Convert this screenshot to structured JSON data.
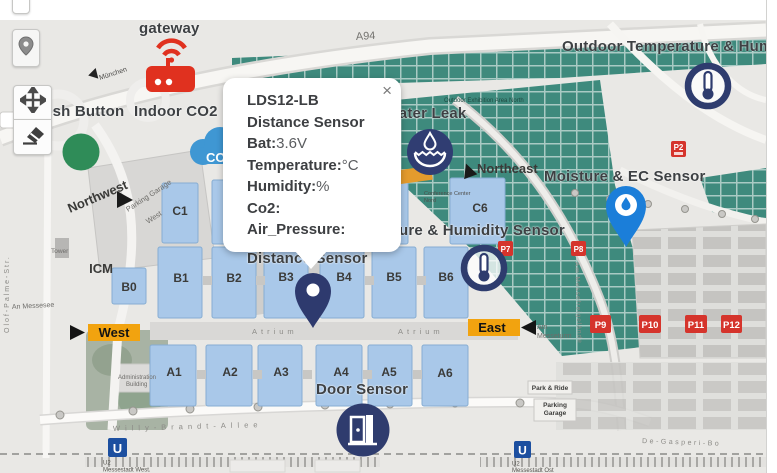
{
  "popup": {
    "title": "LDS12-LB",
    "subtitle": "Distance Sensor",
    "close": "×",
    "fields": [
      {
        "label": "Bat:",
        "value": "3.6V"
      },
      {
        "label": "Temperature:",
        "value": "°C"
      },
      {
        "label": "Humidity:",
        "value": "%"
      },
      {
        "label": "Co2:",
        "value": ""
      },
      {
        "label": "Air_Pressure:",
        "value": ""
      }
    ]
  },
  "sensors": {
    "gateway": "gateway",
    "push_button": "Push Button",
    "indoor_co2": "Indoor CO2",
    "water_leak": "Water Leak",
    "outdoor_temp_humidity": "Outdoor Temperature & Humidity Sensor",
    "moisture_ec": "Moisture & EC Sensor",
    "temp_humidity": "Temperature & Humidity Sensor",
    "distance": "Distance Sensor",
    "door": "Door Sensor",
    "co2_cloud_text": "CO2"
  },
  "map": {
    "highway": "A94",
    "directions": {
      "west": "West",
      "east": "East",
      "northwest": "Northwest",
      "northeast": "Northeast",
      "munich": "München"
    },
    "halls": {
      "c1": "C1",
      "c6": "C6",
      "b0": "B0",
      "b1": "B1",
      "b2": "B2",
      "b3": "B3",
      "b4": "B4",
      "b5": "B5",
      "b6": "B6",
      "a1": "A1",
      "a2": "A2",
      "a3": "A3",
      "a4": "A4",
      "a5": "A5",
      "a6": "A6",
      "icm": "ICM"
    },
    "parking_signs": {
      "p2": "P2",
      "p7": "P7",
      "p8": "P8",
      "p9": "P9",
      "p10": "P10",
      "p11": "P11",
      "p12": "P12"
    },
    "streets": {
      "wba": "Willy-Brandt-Allee",
      "olof": "Olof-Palme-Str.",
      "degasperi": "De-Gasperi-Bo",
      "messeturm1": "Am",
      "messeturm2": "Messeturm",
      "freigelaende": "Am Messefreigelände",
      "messesee": "An Messesee"
    },
    "areas": {
      "pgw1": "Parking Garage",
      "pgw2": "West",
      "tower": "Tower",
      "outdoor_north": "Outdoor Exhibition Area North",
      "conf1": "Conference Center",
      "conf2": "Nord",
      "admin1": "Administration",
      "admin2": "Building",
      "park_ride": "Park & Ride",
      "pg1": "Parking",
      "pg2": "Garage",
      "atrium": "Atrium"
    },
    "transit": {
      "sign": "U",
      "west1": "U2",
      "west2": "Messestadt West.",
      "ost1": "U2",
      "ost2": "Messestadt Ost"
    }
  },
  "colors": {
    "navy_marker": "#2F3C6E",
    "blue_pin": "#1B7ED9",
    "green_marker": "#2F8C58",
    "gateway_red": "#E0311F",
    "banner_orange": "#F2A30F",
    "teal_area": "#3E8A7D",
    "hall_blue": "#A9C8E9",
    "parking_red": "#D5342C",
    "ubahn_blue": "#1C4FA0"
  }
}
